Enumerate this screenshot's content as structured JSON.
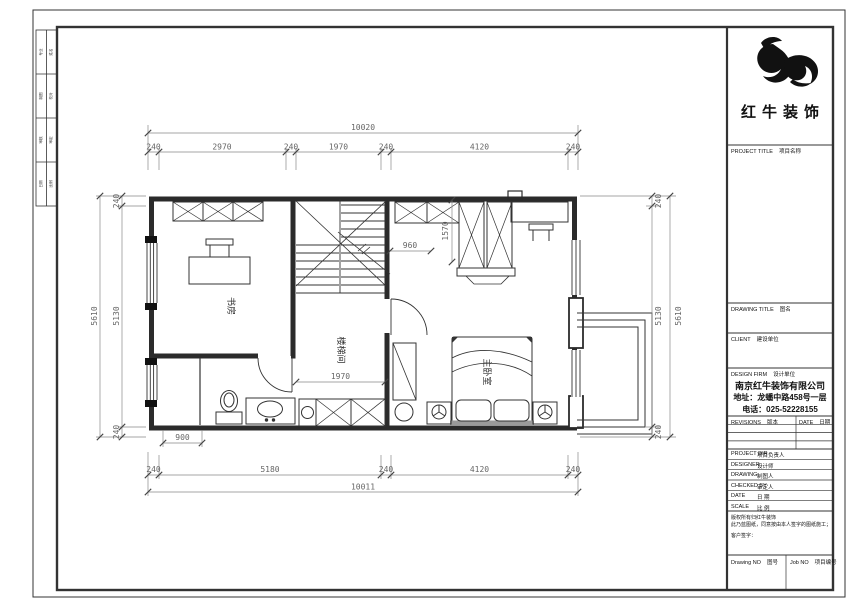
{
  "title_block": {
    "logo_text": "红牛装饰",
    "project_title_en": "PROJECT TITLE",
    "project_title_cn": "项目名称",
    "drawing_title_en": "DRAWING TITLE",
    "drawing_title_cn": "图名",
    "client_en": "CLIENT",
    "client_cn": "建设单位",
    "design_firm_en": "DESIGN FIRM",
    "design_firm_cn": "设计单位",
    "company_name": "南京红牛装饰有限公司",
    "company_address": "地址：龙蟠中路458号一层",
    "company_phone": "电话：025-52228155",
    "revisions_en": "REVISIONS",
    "revisions_cn": "版本",
    "rev_date_en": "DATE",
    "rev_date_cn": "日期",
    "rows": [
      {
        "en": "PROJECT DIR",
        "cn": "项目负责人"
      },
      {
        "en": "DESIGNER",
        "cn": "设计师"
      },
      {
        "en": "DRAWING",
        "cn": "制图人"
      },
      {
        "en": "CHECKED BY",
        "cn": "审定人"
      },
      {
        "en": "DATE",
        "cn": "日 期"
      },
      {
        "en": "SCALE",
        "cn": "比 例"
      }
    ],
    "disclaimer_line1": "版权所有归红牛装饰",
    "disclaimer_line2": "此乃蓝图纸，同意按由本人签字的图纸施工；",
    "disclaimer_line3": "客户签字：",
    "drawing_no_en": "Drawing NO",
    "drawing_no_cn": "图号",
    "job_no_en": "Job NO",
    "job_no_cn": "项目编号"
  },
  "sign_strip": {
    "cells": [
      {
        "a": "专业",
        "b": "姓名"
      },
      {
        "a": "制图",
        "b": "校对"
      },
      {
        "a": "审核",
        "b": "审定"
      },
      {
        "a": "日期",
        "b": "比例"
      }
    ]
  },
  "plan": {
    "rooms": {
      "study": "书房",
      "stair": "楼梯间",
      "bedroom": "主卧室"
    },
    "dims": {
      "top_total": "10020",
      "top_segments": [
        "240",
        "2970",
        "240",
        "1970",
        "240",
        "4120",
        "240"
      ],
      "bottom_total": "10011",
      "bottom_segments": [
        "240",
        "5180",
        "240",
        "4120",
        "240"
      ],
      "bottom_sub": "900",
      "left_total": "5610",
      "left_segments": [
        "240",
        "5130",
        "240"
      ],
      "right_total": "5610",
      "right_segments": [
        "240",
        "5130",
        "240"
      ],
      "hall_width": "1970",
      "closet_gap": "960",
      "closet_run": "1570"
    }
  }
}
